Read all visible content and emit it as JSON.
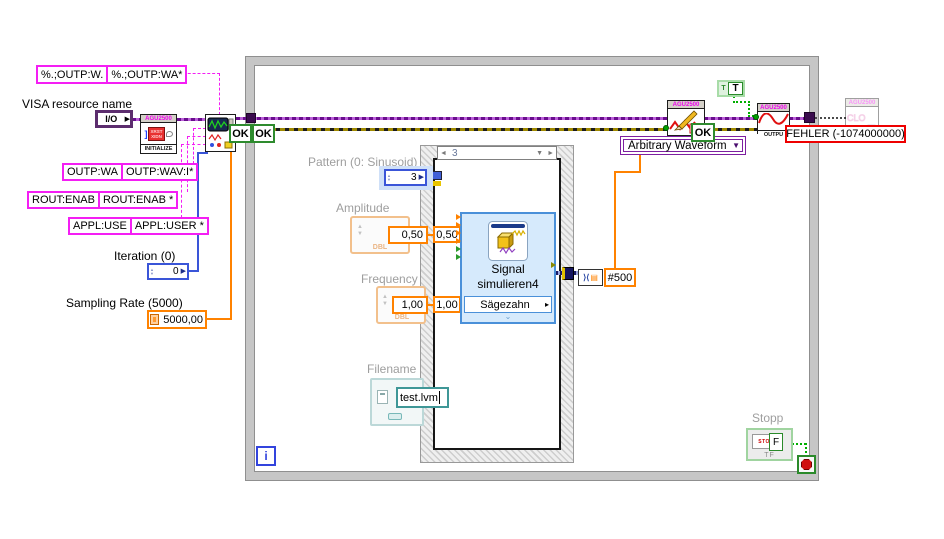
{
  "labels": {
    "visa_resource": "VISA resource name",
    "iteration": "Iteration (0)",
    "sampling_rate": "Sampling Rate (5000)",
    "pattern": "Pattern  (0: Sinusoid)",
    "amplitude": "Amplitude",
    "frequency": "Frequency",
    "filename": "Filename",
    "stop": "Stopp"
  },
  "string_constants": {
    "scpi_1a": "%.;OUTP:W.",
    "scpi_1b": "%.;OUTP:WA*",
    "scpi_2a": "OUTP:WA",
    "scpi_2b": "OUTP:WAV:I*",
    "scpi_3a": "ROUT:ENAB",
    "scpi_3b": "ROUT:ENAB *",
    "scpi_4a": "APPL:USE",
    "scpi_4b": "APPL:USER *"
  },
  "controls": {
    "io_label": "I/O",
    "iteration_value": "0",
    "sampling_value": "5000,00",
    "pattern_value": "3",
    "amplitude": {
      "value": "0,50",
      "tunnel": "0,50",
      "type_tag": "DBL"
    },
    "frequency": {
      "value": "1,00",
      "tunnel": "1,00",
      "type_tag": "DBL"
    },
    "filename_value": "test.lvm",
    "waveform_type": "Arbitrary Waveform",
    "true_constant": "T",
    "stop_button": "STOP",
    "stop_type_tag": "TF",
    "stop_wire_value": "F"
  },
  "vis": {
    "header": "AGU2500",
    "initialize_label": "INITIALIZE",
    "initialize_glyph_line1": "XRST",
    "initialize_glyph_line2": "XIDN",
    "output_label": "OUTPU",
    "status_ok": "OK"
  },
  "express_vi": {
    "name_line1": "Signal",
    "name_line2": "simulieren4",
    "signal_type": "Sägezahn"
  },
  "case_structure": {
    "selector_value": "3"
  },
  "while_loop": {
    "iteration_terminal": "i"
  },
  "wire_labels": {
    "samples": "#500"
  },
  "error_label": "FEHLER (-1074000000)",
  "glyphs": {
    "down_arrow": "▼",
    "right_arrow": "▶",
    "submenu_arrow": "▸",
    "chevron": "⌄",
    "prev": "◄",
    "next": "►"
  },
  "colors": {
    "string_wire_pink": "#F41EF4",
    "visa_wire_purple": "#6A0D8E",
    "error_wire_yellow": "#A08A00",
    "numeric_wire_blue": "#3A55D8",
    "dbl_wire_orange": "#FF8200",
    "boolean_wire_green": "#00AE00",
    "express_vi_blue": "#D6EAFC",
    "error_label_red": "#EE0000"
  }
}
